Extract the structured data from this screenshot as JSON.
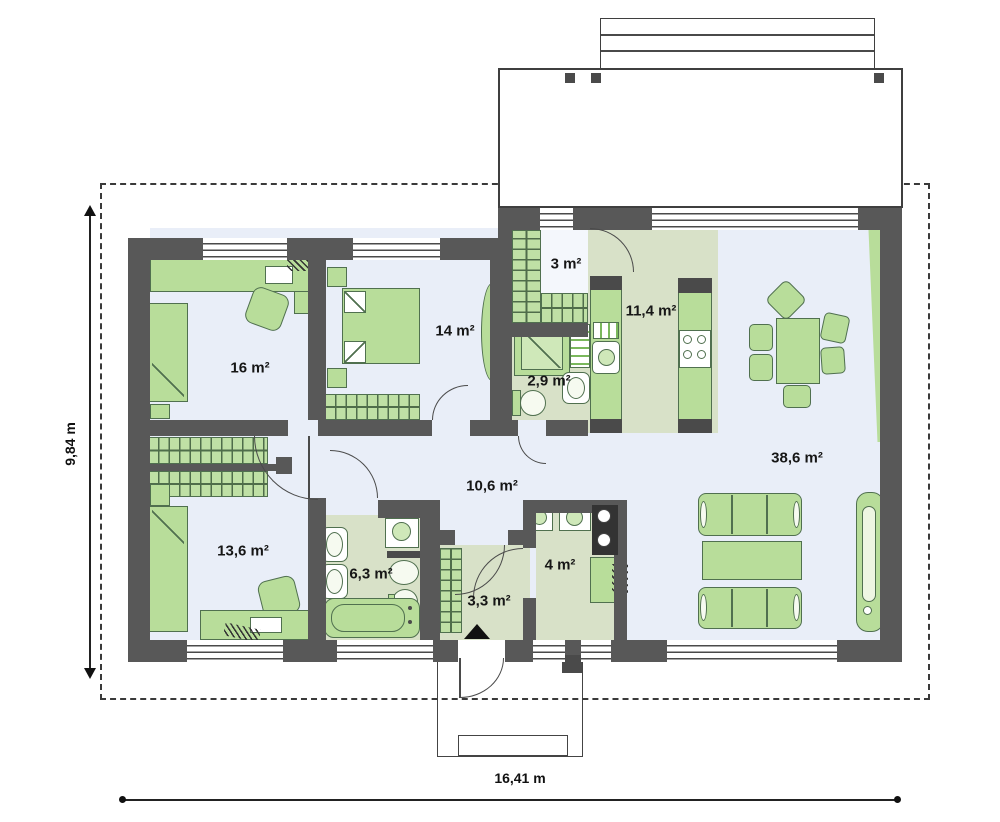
{
  "title": "single-storey house floor plan",
  "rooms": [
    {
      "id": "bedroom-16",
      "label": "16 m²",
      "x": 250,
      "y": 368
    },
    {
      "id": "bedroom-14",
      "label": "14 m²",
      "x": 455,
      "y": 331
    },
    {
      "id": "closet-3",
      "label": "3 m²",
      "x": 566,
      "y": 264
    },
    {
      "id": "kitchen-114",
      "label": "11,4 m²",
      "x": 651,
      "y": 311
    },
    {
      "id": "bath-29",
      "label": "2,9 m²",
      "x": 549,
      "y": 381
    },
    {
      "id": "living-386",
      "label": "38,6 m²",
      "x": 797,
      "y": 458
    },
    {
      "id": "hall-106",
      "label": "10,6 m²",
      "x": 492,
      "y": 486
    },
    {
      "id": "bedroom-136",
      "label": "13,6 m²",
      "x": 243,
      "y": 551
    },
    {
      "id": "bath-63",
      "label": "6,3 m²",
      "x": 371,
      "y": 574
    },
    {
      "id": "entry-33",
      "label": "3,3 m²",
      "x": 489,
      "y": 601
    },
    {
      "id": "utility-4",
      "label": "4 m²",
      "x": 560,
      "y": 565
    }
  ],
  "dimensions": {
    "width_label": "16,41 m",
    "height_label": "9,84 m"
  },
  "colors": {
    "wall": "#585858",
    "floor_dry": "#e9eef8",
    "floor_wet": "#d8e1c8",
    "furniture_fill": "#b8dd9a",
    "furniture_outline": "#50704f",
    "line_dark": "#4a4a4a"
  }
}
